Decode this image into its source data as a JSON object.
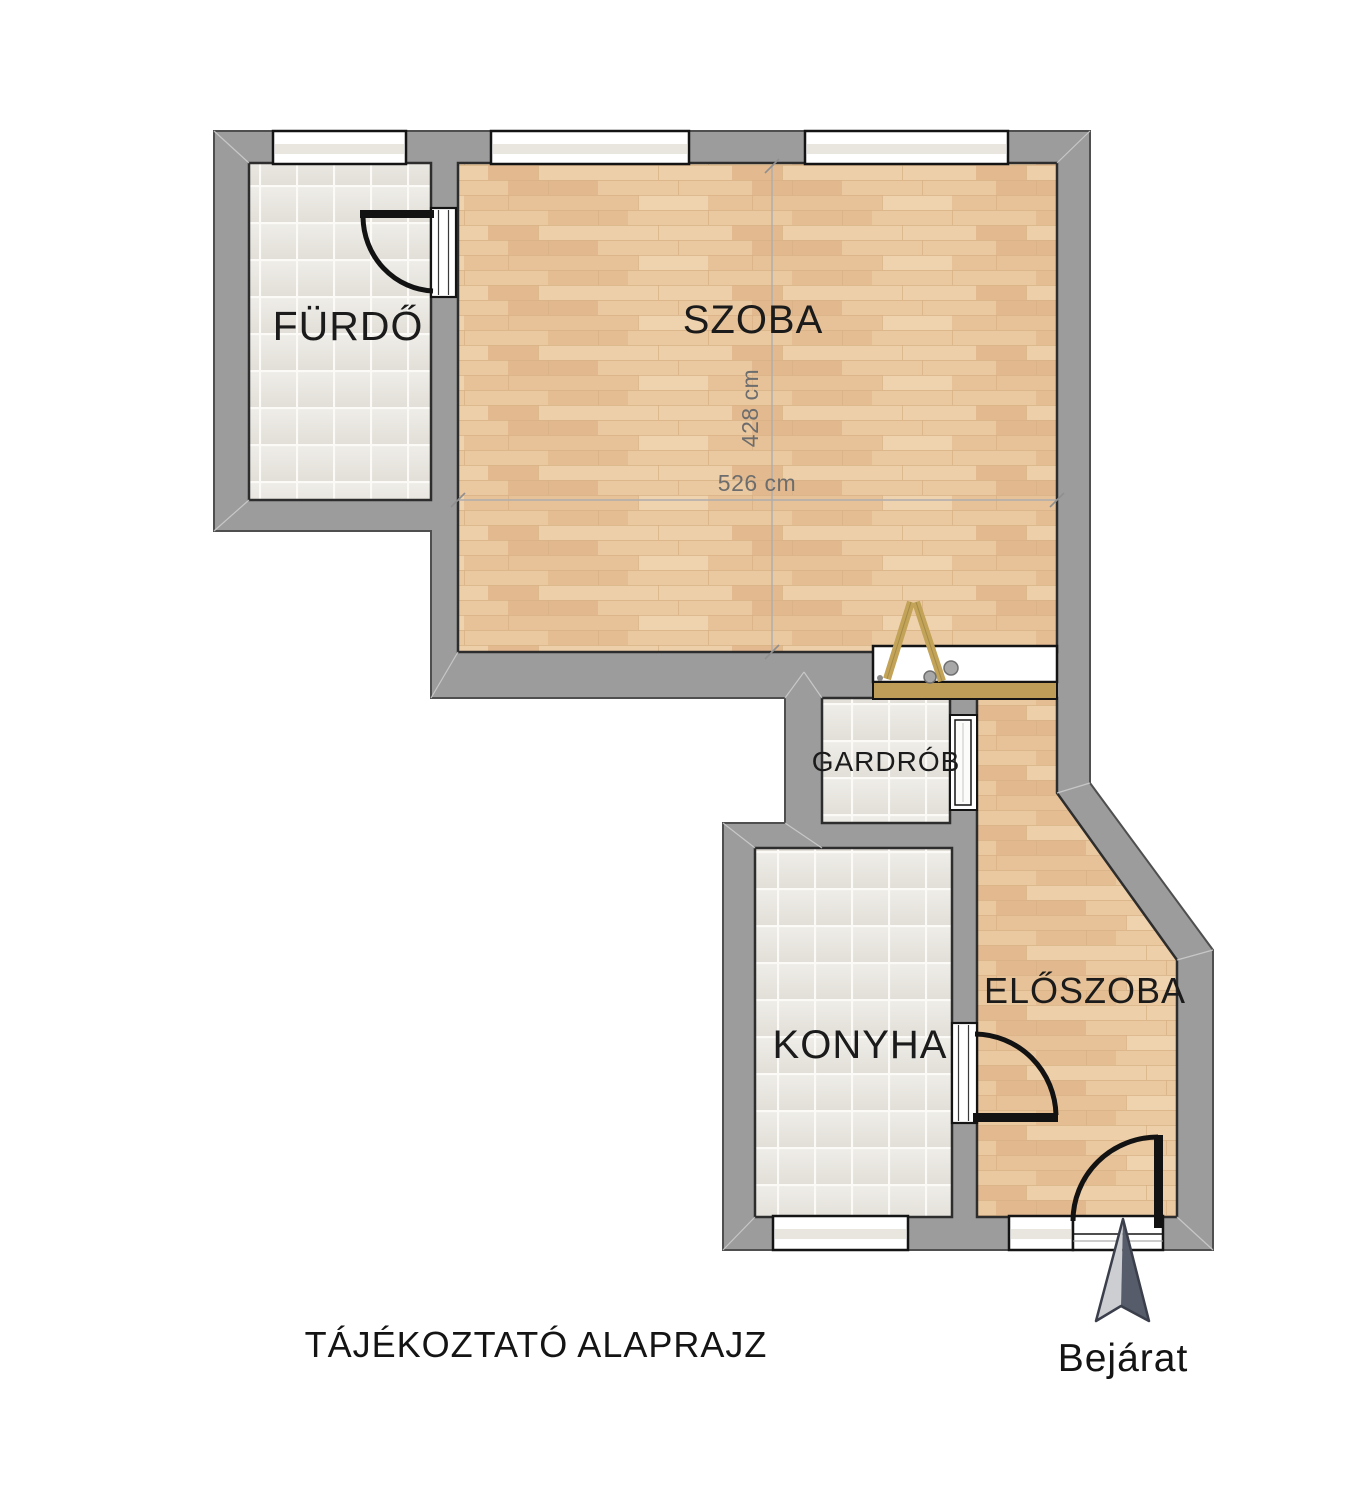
{
  "document": {
    "caption": "TÁJÉKOZTATÓ ALAPRAJZ"
  },
  "rooms": [
    {
      "id": "furdo",
      "label": "FÜRDŐ",
      "floor": "tile"
    },
    {
      "id": "szoba",
      "label": "SZOBA",
      "floor": "wood"
    },
    {
      "id": "gardrob",
      "label": "GARDRÓB",
      "floor": "tile"
    },
    {
      "id": "konyha",
      "label": "KONYHA",
      "floor": "tile"
    },
    {
      "id": "eloszoba",
      "label": "ELŐSZOBA",
      "floor": "wood"
    }
  ],
  "dimensions": {
    "szoba_width": "526 cm",
    "szoba_height": "428 cm"
  },
  "entrance": {
    "label": "Bejárat"
  },
  "colors": {
    "wall": "#9c9c9c",
    "wall_outline": "#4f4f4f",
    "room_outline": "#2d2d2d",
    "wood_floor": "#eac9a1",
    "tile_floor": "#e9e6e0",
    "plank": "#bd9d58",
    "ladder": "#c2a358",
    "door": "#121212",
    "dimension_line": "#adadad",
    "dimension_text": "#6d6d6d",
    "label_text": "#1b1b1b",
    "arrow_dark": "#575c6b",
    "arrow_light": "#cdced2"
  }
}
